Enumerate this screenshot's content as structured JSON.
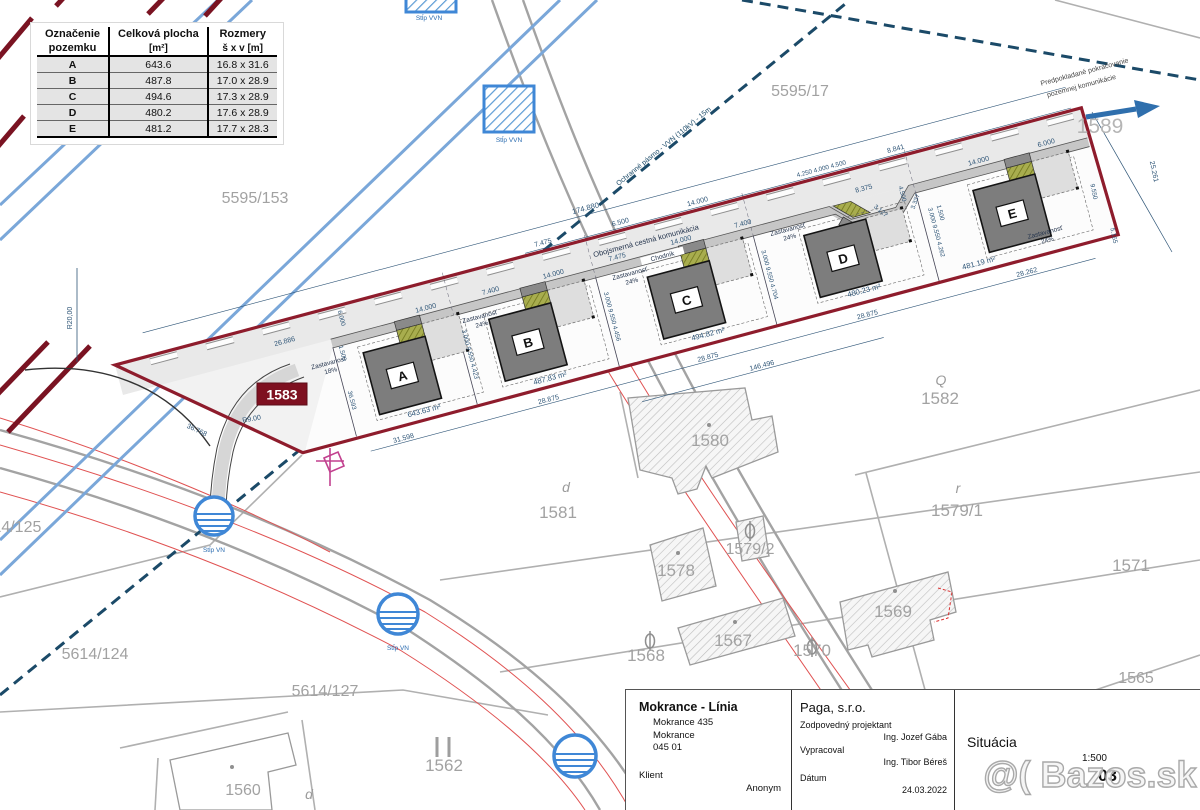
{
  "table": {
    "headers": {
      "col1a": "Označenie",
      "col1b": "pozemku",
      "col2": "Celková plocha",
      "col2_sub": "[m²]",
      "col3": "Rozmery",
      "col3_sub": "š x v [m]"
    },
    "rows": [
      {
        "id": "A",
        "area": "643.6",
        "size": "16.8 x 31.6"
      },
      {
        "id": "B",
        "area": "487.8",
        "size": "17.0 x 28.9"
      },
      {
        "id": "C",
        "area": "494.6",
        "size": "17.3 x 28.9"
      },
      {
        "id": "D",
        "area": "480.2",
        "size": "17.6 x 28.9"
      },
      {
        "id": "E",
        "area": "481.2",
        "size": "17.7 x 28.3"
      }
    ]
  },
  "houses": [
    {
      "letter": "A",
      "area": "643.63 m²",
      "coverage_label": "Zastavanosť",
      "coverage": "18%"
    },
    {
      "letter": "B",
      "area": "487.83 m²",
      "coverage_label": "Zastavanosť",
      "coverage": "24%"
    },
    {
      "letter": "C",
      "area": "494.82 m²",
      "coverage_label": "Zastavanosť",
      "coverage": "24%"
    },
    {
      "letter": "D",
      "area": "480.23 m²",
      "coverage_label": "Zastavanosť",
      "coverage": "24%"
    },
    {
      "letter": "E",
      "area": "481.19 m²",
      "coverage_label": "Zastavanosť",
      "coverage": "24%"
    }
  ],
  "parcels": {
    "n5595_17": "5595/17",
    "n5595_153": "5595/153",
    "n1589": "1589",
    "n1583": "1583",
    "n1582": "1582",
    "n1581": "1581",
    "n1580": "1580",
    "n1579_1": "1579/1",
    "n1579_2": "1579/2",
    "n1578": "1578",
    "n1571": "1571",
    "n1569": "1569",
    "n1570": "1570",
    "n1567": "1567",
    "n1568": "1568",
    "n1565": "1565",
    "n1562": "1562",
    "n1560": "1560",
    "n5614_124": "5614/124",
    "n5614_125": "5614/125",
    "n5614_127": "5614/127",
    "glyph_d1": "d",
    "glyph_d2": "d",
    "glyph_r": "r",
    "glyph_q": "Q"
  },
  "annotations": {
    "road": "Obojsmerná cestná komunikácia",
    "sidewalk": "Chodník",
    "protection": "Ochranné pásmo - VVN (110kV) - 15m",
    "continuation1": "Predpokladané pokračovanie",
    "continuation2": "pozemnej komunikácie",
    "pylon_vvn": "Stĺp VVN",
    "pole_vn": "Stĺp VN"
  },
  "dims": {
    "t_total": "174.880",
    "t_entry": "26.886",
    "o1": "7.475",
    "o2": "6.500",
    "o3": "14.000",
    "o4": "4.250 4.000 4.500",
    "o5": "8.841",
    "i1": "14.000",
    "i2": "7.400",
    "i3": "14.000",
    "i4": "7.475",
    "i5": "14.000",
    "i6": "7.400",
    "i7": "8.375",
    "i8": "14.000",
    "i9": "6.000",
    "b1": "31.598",
    "b2": "28.875",
    "b3": "28.875",
    "b4": "28.875",
    "b5": "28.262",
    "b6": "146.496",
    "v1": "6.000",
    "v2": "1.500",
    "v3": "36.593",
    "v4": "3.000  9.550  4.423",
    "v5": "3.000  9.550  4.456",
    "v6": "3.000  9.550  4.704",
    "v7": "3.000  9.550  4.262",
    "v8": "4.500",
    "v9": "3.127",
    "v10": "3.337",
    "v11": "1.500",
    "r_r20": "R20,00",
    "r_r9": "R9.00",
    "r_36768": "36.768",
    "r_25261": "25.261",
    "r_9550": "9.550",
    "r_5165": "5.165"
  },
  "title_block": {
    "project": "Mokrance - Línia",
    "address1": "Mokrance 435",
    "address2": "Mokrance",
    "zip": "045 01",
    "client_label": "Klient",
    "client": "Anonym",
    "company": "Paga, s.r.o.",
    "role1": "Zodpovedný projektant",
    "name1": "Ing. Jozef Gába",
    "role2": "Vypracoval",
    "name2": "Ing. Tibor Béreš",
    "date_label": "Dátum",
    "date": "24.03.2022",
    "drawing": "Situácia",
    "scale": "1:500",
    "number": "03"
  },
  "watermark": "@( Bazos.sk",
  "colors": {
    "boundary": "#8e1c2c",
    "dims": "#2e5577",
    "power": "#7aa7d9",
    "protection": "#1b4a68"
  }
}
